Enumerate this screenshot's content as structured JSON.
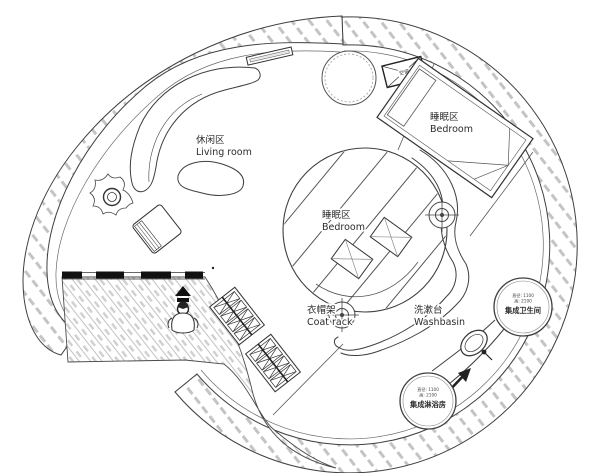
{
  "colors": {
    "line": "#3f3f3f",
    "wall_hatch": "#c4c4c4",
    "floor_line": "#9a9a9a",
    "floor_dash": "#cfcfcf",
    "black": "#111111",
    "background": "#ffffff"
  },
  "zones": {
    "living_room": {
      "label_zh": "休闲区",
      "label_en": "Living room"
    },
    "bedroom_upper": {
      "label_zh": "睡眠区",
      "label_en": "Bedroom"
    },
    "bedroom_center": {
      "label_zh": "睡眠区",
      "label_en": "Bedroom"
    },
    "coat_rack": {
      "label_zh": "衣帽架",
      "label_en": "Coat rack"
    },
    "washbasin": {
      "label_zh": "洗漱台",
      "label_en": "Washbasin"
    }
  },
  "pods": {
    "toilet": {
      "name": "集成卫生间",
      "spec1": "直径: 1100",
      "spec2": "高: 2100"
    },
    "shower": {
      "name": "集成淋浴房",
      "spec1": "直径: 1100",
      "spec2": "高: 2100"
    }
  },
  "equipment": {
    "ac": "空调"
  }
}
